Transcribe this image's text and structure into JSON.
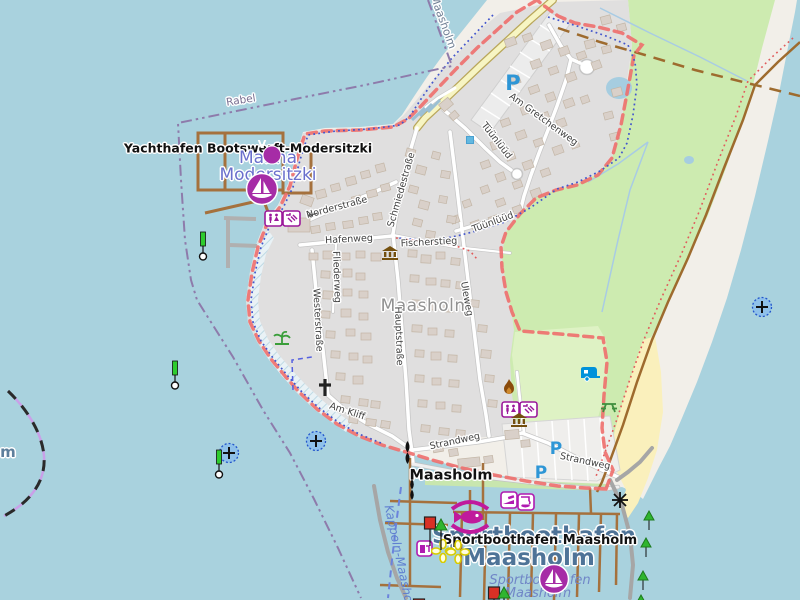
{
  "map": {
    "pois": {
      "yachthafen_label": "Yachthafen Bootswerft-Modersitzki",
      "marina_name_line1": "Marina",
      "marina_name_line2": "Modersitzki",
      "town_label": "Maasholm",
      "ferry_stop_label": "Maasholm",
      "harbor_area_line1": "Sportboothafen",
      "harbor_area_line2": "Maasholm",
      "harbor_poi_label": "Sportboothafen Maasholm",
      "harbor_water_line1": "Sportboothafen",
      "harbor_water_line2": "Maasholm",
      "ferry_route_label": "Kappeln-Maasholm",
      "boundary_label_rabel": "Rabel",
      "boundary_label_maasholm": "Maasholm",
      "water_label_fragment": "m"
    },
    "streets": {
      "norderstrasse": "Norderstraße",
      "schmiedestrasse": "Schmiedestraße",
      "hafenweg": "Hafenweg",
      "fischerstieg": "Fischerstieg",
      "fliederweg": "Fliederweg",
      "westerstrasse": "Westerstraße",
      "hauptstrasse": "Hauptstraße",
      "uleweg": "Uleweg",
      "tuunluud_1": "Tüünlüüd",
      "tuunluud_2": "Tüünlüüd",
      "am_gretchenweg": "Am Gretchenweg",
      "am_kliff": "Am Kliff",
      "strandweg_1": "Strandweg",
      "strandweg_2": "Strandweg"
    },
    "icon_glyphs": {
      "parking": "P",
      "vending_v": "V",
      "oneway_arrow": "←"
    },
    "colors": {
      "water": "#a9d2de",
      "land": "#f2efe9",
      "residential": "#e0dfdf",
      "grass": "#cdebb0",
      "campsite": "#def2c4",
      "sand": "#faf0bc",
      "building": "#d9d0c9",
      "pier_wood": "#a5713d",
      "boundary_red": "#ef6f6d",
      "admin_purple": "#8e7bab",
      "poi_purple": "#a62ca6",
      "harbor_blue": "#4e7397",
      "parking_blue": "#2e96d6"
    },
    "buildings": [
      [
        505,
        38,
        11,
        8,
        -20
      ],
      [
        523,
        34,
        9,
        7,
        -20
      ],
      [
        541,
        41,
        11,
        8,
        -20
      ],
      [
        559,
        47,
        10,
        8,
        -20
      ],
      [
        577,
        52,
        9,
        7,
        -20
      ],
      [
        592,
        61,
        9,
        8,
        -20
      ],
      [
        531,
        60,
        10,
        8,
        -20
      ],
      [
        549,
        67,
        9,
        7,
        -20
      ],
      [
        566,
        73,
        10,
        8,
        -20
      ],
      [
        511,
        76,
        9,
        8,
        -20
      ],
      [
        529,
        86,
        10,
        7,
        -20
      ],
      [
        546,
        93,
        9,
        8,
        -20
      ],
      [
        564,
        99,
        10,
        8,
        -20
      ],
      [
        581,
        96,
        8,
        7,
        -20
      ],
      [
        521,
        106,
        9,
        8,
        -20
      ],
      [
        539,
        113,
        10,
        7,
        -20
      ],
      [
        557,
        119,
        9,
        8,
        -20
      ],
      [
        501,
        119,
        9,
        7,
        -20
      ],
      [
        516,
        131,
        10,
        8,
        -20
      ],
      [
        534,
        139,
        9,
        7,
        -20
      ],
      [
        553,
        146,
        10,
        8,
        -20
      ],
      [
        571,
        141,
        8,
        7,
        -20
      ],
      [
        491,
        141,
        9,
        8,
        -20
      ],
      [
        506,
        153,
        9,
        7,
        -20
      ],
      [
        523,
        161,
        10,
        8,
        -20
      ],
      [
        541,
        169,
        9,
        7,
        -20
      ],
      [
        481,
        161,
        9,
        7,
        -20
      ],
      [
        496,
        173,
        9,
        8,
        -20
      ],
      [
        513,
        181,
        9,
        7,
        -20
      ],
      [
        531,
        189,
        10,
        8,
        -20
      ],
      [
        481,
        186,
        8,
        7,
        -20
      ],
      [
        496,
        199,
        9,
        7,
        -20
      ],
      [
        513,
        206,
        9,
        7,
        -20
      ],
      [
        463,
        200,
        8,
        7,
        -20
      ],
      [
        451,
        216,
        8,
        7,
        -20
      ],
      [
        471,
        221,
        9,
        7,
        -20
      ],
      [
        489,
        216,
        9,
        7,
        -20
      ],
      [
        585,
        40,
        10,
        8,
        -15
      ],
      [
        602,
        46,
        9,
        7,
        -15
      ],
      [
        612,
        88,
        10,
        8,
        -15
      ],
      [
        604,
        112,
        9,
        7,
        -15
      ],
      [
        610,
        133,
        9,
        7,
        -15
      ],
      [
        601,
        16,
        10,
        8,
        -15
      ],
      [
        617,
        24,
        9,
        7,
        -15
      ],
      [
        440,
        100,
        12,
        9,
        -40
      ],
      [
        450,
        112,
        8,
        7,
        -40
      ],
      [
        316,
        190,
        10,
        8,
        -15
      ],
      [
        331,
        184,
        9,
        7,
        -15
      ],
      [
        346,
        177,
        10,
        8,
        -15
      ],
      [
        361,
        171,
        9,
        7,
        -15
      ],
      [
        376,
        164,
        9,
        8,
        -15
      ],
      [
        352,
        196,
        9,
        7,
        -15
      ],
      [
        367,
        190,
        10,
        7,
        -15
      ],
      [
        381,
        184,
        9,
        7,
        -15
      ],
      [
        406,
        149,
        9,
        8,
        15
      ],
      [
        416,
        166,
        10,
        8,
        15
      ],
      [
        409,
        186,
        9,
        7,
        15
      ],
      [
        419,
        201,
        10,
        8,
        15
      ],
      [
        413,
        219,
        9,
        7,
        15
      ],
      [
        426,
        231,
        9,
        7,
        10
      ],
      [
        432,
        152,
        8,
        7,
        15
      ],
      [
        441,
        171,
        9,
        7,
        10
      ],
      [
        439,
        196,
        8,
        7,
        10
      ],
      [
        447,
        216,
        9,
        7,
        10
      ],
      [
        311,
        226,
        9,
        7,
        -8
      ],
      [
        326,
        223,
        9,
        7,
        -8
      ],
      [
        343,
        221,
        10,
        7,
        -8
      ],
      [
        359,
        217,
        9,
        7,
        -8
      ],
      [
        373,
        213,
        9,
        7,
        -8
      ],
      [
        309,
        253,
        9,
        7,
        0
      ],
      [
        323,
        251,
        10,
        8,
        0
      ],
      [
        341,
        253,
        9,
        7,
        0
      ],
      [
        356,
        251,
        9,
        7,
        0
      ],
      [
        371,
        253,
        10,
        8,
        0
      ],
      [
        321,
        271,
        9,
        7,
        3
      ],
      [
        343,
        269,
        9,
        8,
        0
      ],
      [
        356,
        273,
        9,
        7,
        0
      ],
      [
        323,
        291,
        10,
        8,
        3
      ],
      [
        343,
        289,
        9,
        7,
        0
      ],
      [
        359,
        291,
        9,
        7,
        0
      ],
      [
        321,
        311,
        9,
        7,
        3
      ],
      [
        341,
        309,
        10,
        8,
        0
      ],
      [
        359,
        313,
        9,
        7,
        0
      ],
      [
        326,
        331,
        9,
        7,
        3
      ],
      [
        346,
        329,
        9,
        7,
        0
      ],
      [
        361,
        333,
        10,
        7,
        0
      ],
      [
        331,
        351,
        9,
        7,
        3
      ],
      [
        349,
        353,
        9,
        7,
        0
      ],
      [
        363,
        356,
        9,
        7,
        0
      ],
      [
        336,
        373,
        9,
        7,
        3
      ],
      [
        353,
        376,
        10,
        8,
        0
      ],
      [
        341,
        396,
        9,
        7,
        5
      ],
      [
        359,
        399,
        9,
        7,
        5
      ],
      [
        371,
        401,
        9,
        7,
        5
      ],
      [
        349,
        416,
        9,
        7,
        8
      ],
      [
        366,
        419,
        10,
        7,
        8
      ],
      [
        381,
        421,
        9,
        7,
        8
      ],
      [
        408,
        250,
        9,
        7,
        3
      ],
      [
        421,
        255,
        10,
        8,
        3
      ],
      [
        436,
        252,
        9,
        7,
        0
      ],
      [
        451,
        258,
        9,
        7,
        5
      ],
      [
        410,
        275,
        9,
        7,
        3
      ],
      [
        426,
        278,
        10,
        7,
        0
      ],
      [
        441,
        280,
        9,
        7,
        3
      ],
      [
        456,
        282,
        9,
        7,
        5
      ],
      [
        412,
        300,
        9,
        7,
        3
      ],
      [
        428,
        302,
        9,
        8,
        0
      ],
      [
        444,
        305,
        9,
        7,
        3
      ],
      [
        412,
        325,
        10,
        7,
        3
      ],
      [
        428,
        328,
        9,
        7,
        0
      ],
      [
        445,
        330,
        9,
        7,
        3
      ],
      [
        415,
        350,
        9,
        7,
        3
      ],
      [
        431,
        352,
        10,
        8,
        0
      ],
      [
        448,
        355,
        9,
        7,
        3
      ],
      [
        415,
        375,
        9,
        7,
        3
      ],
      [
        432,
        378,
        9,
        7,
        0
      ],
      [
        449,
        380,
        10,
        7,
        3
      ],
      [
        418,
        400,
        9,
        7,
        3
      ],
      [
        436,
        402,
        9,
        7,
        0
      ],
      [
        452,
        405,
        9,
        7,
        3
      ],
      [
        421,
        425,
        9,
        7,
        5
      ],
      [
        439,
        428,
        10,
        7,
        5
      ],
      [
        456,
        430,
        9,
        7,
        5
      ],
      [
        470,
        300,
        9,
        7,
        5
      ],
      [
        478,
        325,
        9,
        7,
        5
      ],
      [
        481,
        350,
        10,
        8,
        5
      ],
      [
        485,
        375,
        9,
        7,
        5
      ],
      [
        488,
        400,
        9,
        7,
        5
      ],
      [
        433,
        445,
        10,
        7,
        -10
      ],
      [
        449,
        449,
        9,
        7,
        -10
      ],
      [
        458,
        458,
        22,
        9,
        -6
      ],
      [
        484,
        456,
        9,
        7,
        -8
      ],
      [
        505,
        430,
        14,
        9,
        -5
      ],
      [
        521,
        440,
        9,
        7,
        -5
      ],
      [
        288,
        218,
        22,
        14,
        0
      ],
      [
        301,
        196,
        12,
        9,
        20
      ]
    ]
  }
}
